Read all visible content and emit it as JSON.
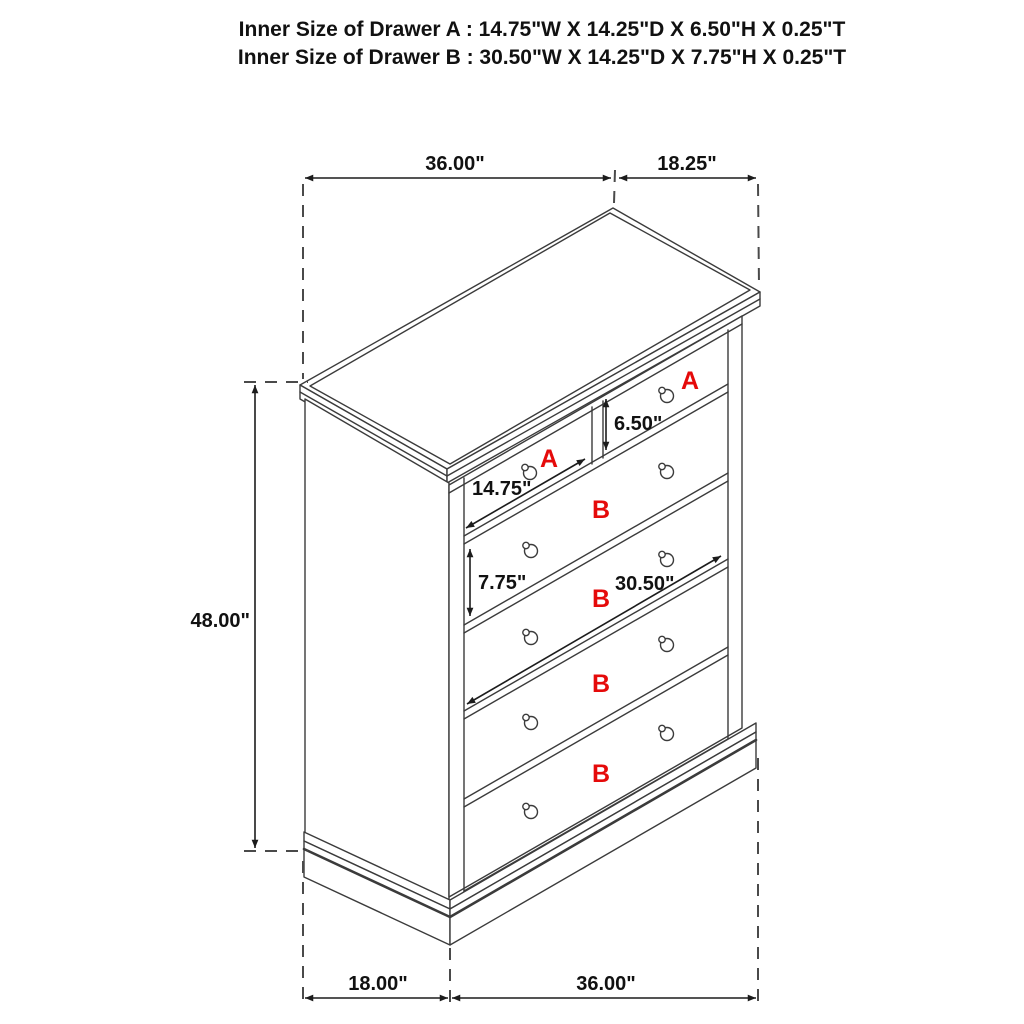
{
  "title": {
    "line1": "Inner Size of Drawer A : 14.75\"W X 14.25\"D X 6.50\"H X 0.25\"T",
    "line2": "Inner Size of Drawer B : 30.50\"W X 14.25\"D X 7.75\"H X 0.25\"T"
  },
  "dimensions": {
    "top_width": "36.00\"",
    "top_depth": "18.25\"",
    "height": "48.00\"",
    "bottom_depth": "18.00\"",
    "bottom_width": "36.00\"",
    "drawer_a_height": "6.50\"",
    "drawer_a_width": "14.75\"",
    "drawer_b_height": "7.75\"",
    "drawer_b_width": "30.50\""
  },
  "drawer_labels": {
    "a_left": "A",
    "a_right": "A",
    "b1": "B",
    "b2": "B",
    "b3": "B",
    "b4": "B"
  },
  "colors": {
    "line": "#3b3b3b",
    "dimension": "#1c1c1c",
    "accent_red": "#e50a0a",
    "background": "#ffffff"
  }
}
